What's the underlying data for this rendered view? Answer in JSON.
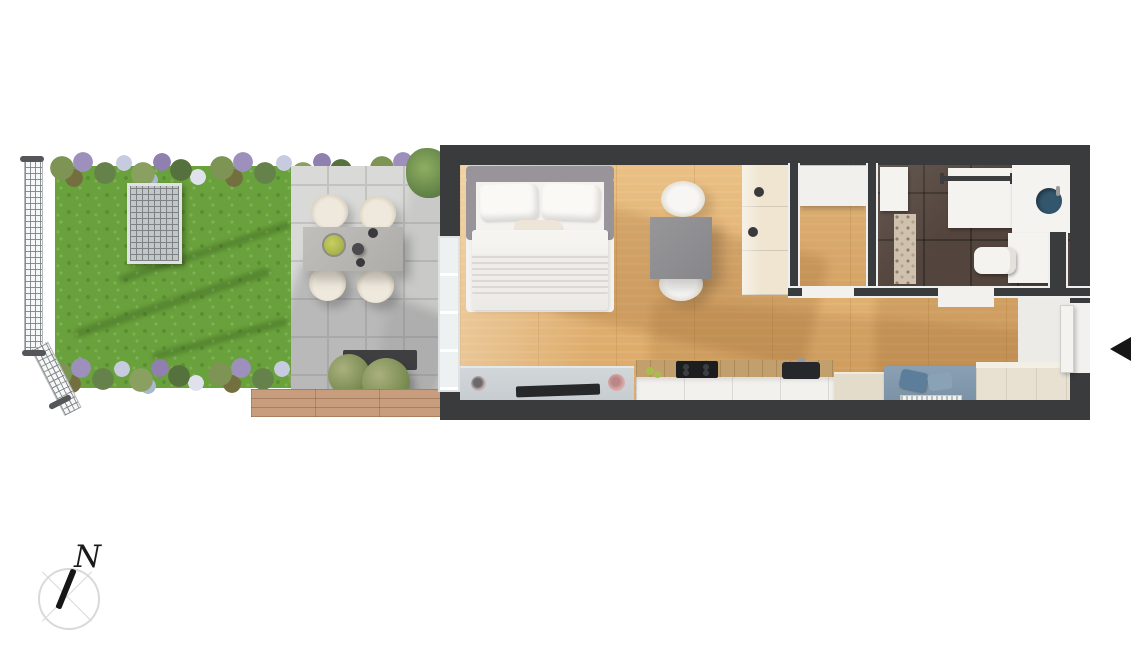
{
  "meta": {
    "width": 1136,
    "height": 663,
    "background": "#ffffff",
    "kind": "apartment-floor-plan-render-with-garden"
  },
  "compass": {
    "icon": "compass-icon",
    "north_label": "N"
  },
  "entrance_marker": {
    "icon": "arrow-left-icon",
    "color": "#161616"
  },
  "palette": {
    "wall": "#3a3b3d",
    "wallface": "#edeff0",
    "wood": "#e2b274",
    "grass": "#69a13c",
    "terrace": "#d9dad8",
    "grout": "#c2c3c1",
    "concrete": "#b7b6b2",
    "chair": "#efe9dd",
    "bush": "#7d8f55",
    "deck": "#c89d7e",
    "grate": "#c2c6c7",
    "bedframe": "#98949a",
    "bedding": "#f4f2ef",
    "pillow": "#fbf9f6",
    "graytable": "#8f8e90",
    "tvboard": "#c6ccd0",
    "tv": "#27282a",
    "cabwhite": "#f3f1ee",
    "counterwood": "#c2a06e",
    "cooktop": "#1c1d1f",
    "sinkdark": "#26272a",
    "tallcab": "#efe5d1",
    "bathtile": "#53453d",
    "showertile": "#cfc1ae",
    "fixture": "#f5f3f0",
    "sinkbowl": "#33566d",
    "towelbar": "#3c3d3f",
    "sofa": "#7b92a6",
    "sofapillow": "#5c7e9b",
    "closet": "#e8e0d1",
    "lightfloor": "#ecebe7",
    "pink": "#d9a8a6",
    "ink": "#161616",
    "ring": "#d9d9d9"
  },
  "scene": {
    "garden_features": [
      "lawn",
      "flower-bed-top",
      "flower-bed-bottom",
      "mesh-fence",
      "drain-grate",
      "paved-terrace",
      "outdoor-dining-table",
      "outdoor-chairs",
      "fruit-bowl",
      "potted-bushes",
      "wood-deck"
    ],
    "apartment_rooms": [
      "living-bedroom",
      "kitchen",
      "hallway",
      "storage-room",
      "bathroom"
    ],
    "apartment_furniture": [
      "double-bed",
      "dining-table",
      "dining-chairs",
      "tv-sideboard",
      "tv",
      "kitchen-counter",
      "cooktop",
      "kitchen-sink",
      "tall-cabinets",
      "bench-sofa",
      "entry-closet",
      "radiator",
      "washbasin",
      "toilet",
      "shower",
      "towel-rail-cabinet",
      "washer-cabinet",
      "glass-terrace-door",
      "entry-door"
    ]
  }
}
